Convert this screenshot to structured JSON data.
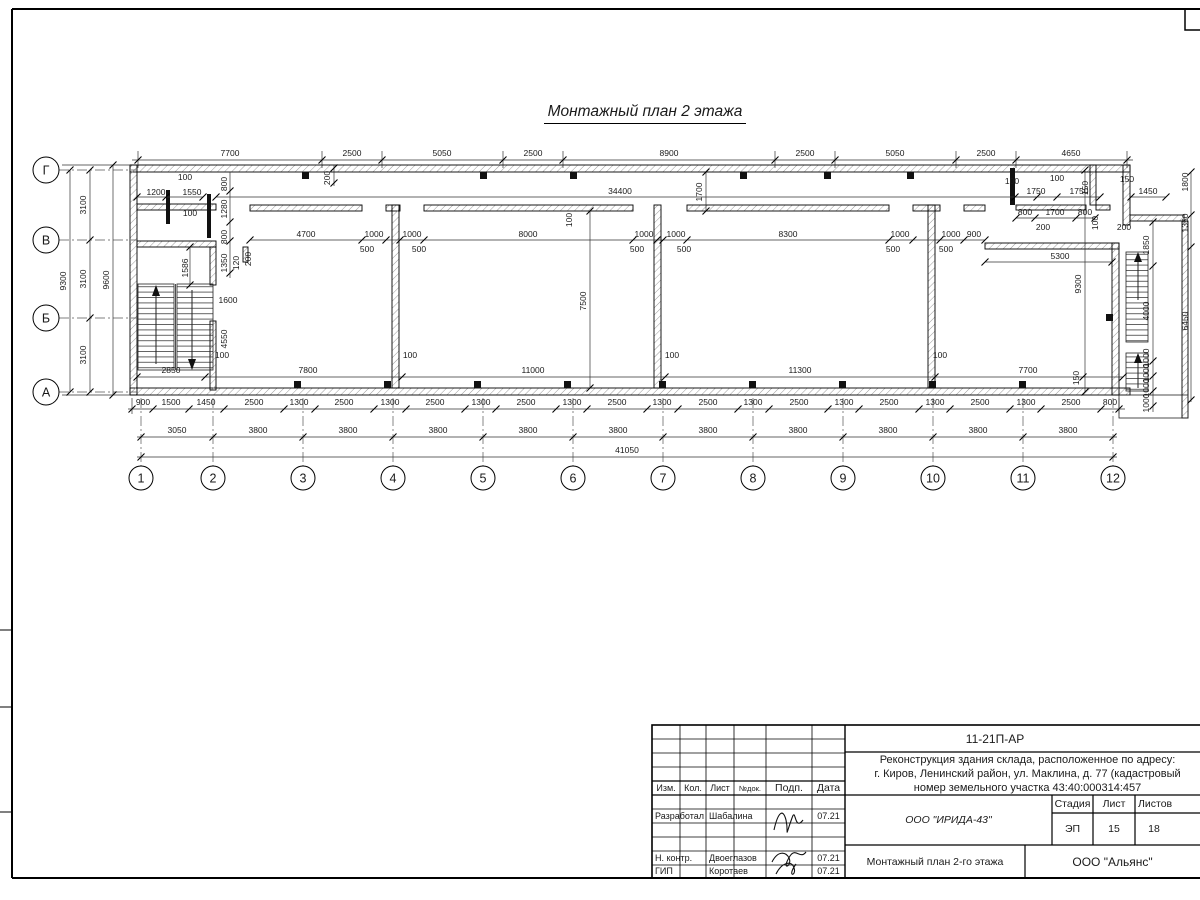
{
  "sheet_title": "Монтажный план 2 этажа",
  "axes": {
    "cols": [
      "1",
      "2",
      "3",
      "4",
      "5",
      "6",
      "7",
      "8",
      "9",
      "10",
      "11",
      "12"
    ],
    "rows": [
      "Г",
      "В",
      "Б",
      "А"
    ]
  },
  "dims": {
    "top": [
      "7700",
      "2500",
      "5050",
      "2500",
      "8900",
      "2500",
      "5050",
      "2500",
      "4650"
    ],
    "fine": [
      "900",
      "1500",
      "1450",
      "2500",
      "1300",
      "2500",
      "1300",
      "2500",
      "1300",
      "2500",
      "1300",
      "2500",
      "1300",
      "2500",
      "1300",
      "2500",
      "1300",
      "2500",
      "1300",
      "2500",
      "1300",
      "2500",
      "800"
    ],
    "mid": [
      "3050",
      "3800",
      "3800",
      "3800",
      "3800",
      "3800",
      "3800",
      "3800",
      "3800",
      "3800",
      "3800"
    ],
    "total": "41050",
    "left": [
      "3100",
      "3100",
      "3100",
      "9300",
      "9600"
    ],
    "stair_left": [
      "100",
      "1200",
      "1550",
      "100",
      "800",
      "1280",
      "800",
      "1350",
      "120",
      "200",
      "1586",
      "1600",
      "4550"
    ],
    "row_v": [
      "4700",
      "1000",
      "500",
      "1000",
      "500",
      "8000",
      "1000",
      "500",
      "1000",
      "500",
      "8300",
      "1000",
      "500",
      "1000",
      "500",
      "900"
    ],
    "row_a": [
      "2850",
      "100",
      "7800",
      "100",
      "11000",
      "100",
      "11300",
      "100",
      "7700",
      "150"
    ],
    "misc": [
      "7500",
      "34400",
      "1700",
      "200",
      "100"
    ],
    "top_right": [
      "100",
      "100",
      "150",
      "1750",
      "1750",
      "150",
      "1450",
      "800",
      "1700",
      "800",
      "200",
      "200"
    ],
    "right": [
      "5300",
      "9300",
      "1850",
      "4000",
      "1000",
      "1000",
      "1000",
      "1000",
      "1350",
      "6450",
      "1800",
      "100"
    ]
  },
  "titleblock": {
    "doc_code": "11-21П-АР",
    "desc_line1": "Реконструкция здания склада, расположенное по адресу:",
    "desc_line2": "г. Киров, Ленинский район, ул. Маклина, д. 77 (кадастровый",
    "desc_line3": "номер земельного участка 43:40:000314:457",
    "col_izm": "Изм.",
    "col_kol": "Кол.",
    "col_list": "Лист",
    "col_ndok": "№док.",
    "col_podp": "Подп.",
    "col_data": "Дата",
    "r1_role": "Разработал",
    "r1_name": "Шабалина",
    "r1_date": "07.21",
    "r2_role": "Н. контр.",
    "r2_name": "Двоеглазов",
    "r2_date": "07.21",
    "r3_role": "ГИП",
    "r3_name": "Коротаев",
    "r3_date": "07.21",
    "org": "ООО \"ИРИДА-43\"",
    "stage_label": "Стадия",
    "list_label": "Лист",
    "listov_label": "Листов",
    "stage": "ЭП",
    "list_no": "15",
    "listov_no": "18",
    "drawing_name": "Монтажный план 2-го этажа",
    "company": "ООО \"Альянс\""
  }
}
